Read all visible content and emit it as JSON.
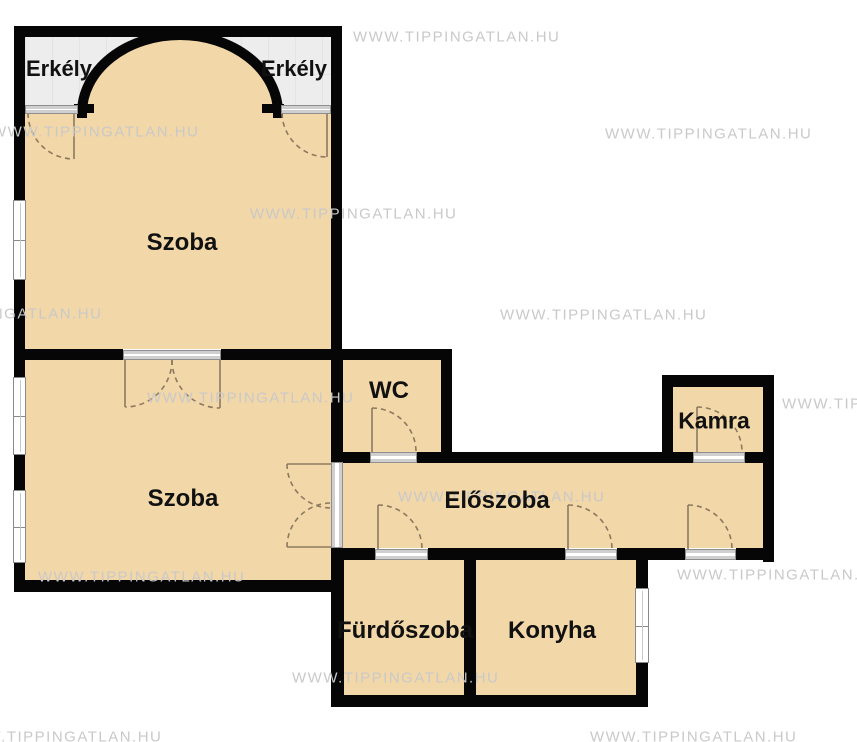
{
  "floor_plan": {
    "rooms": [
      {
        "id": "erkely-left",
        "label": "Erkély"
      },
      {
        "id": "erkely-right",
        "label": "Erkély"
      },
      {
        "id": "szoba-1",
        "label": "Szoba"
      },
      {
        "id": "szoba-2",
        "label": "Szoba"
      },
      {
        "id": "wc",
        "label": "WC"
      },
      {
        "id": "kamra",
        "label": "Kamra"
      },
      {
        "id": "eloszoba",
        "label": "Előszoba"
      },
      {
        "id": "furdoszoba",
        "label": "Fürdőszoba"
      },
      {
        "id": "konyha",
        "label": "Konyha"
      }
    ],
    "watermark": {
      "text": "WWW.TIPPINGATLAN.HU"
    },
    "colors": {
      "room": "#f2d7a8",
      "wall": "#060606",
      "balcony": "#ededed",
      "outside": "#ffffff",
      "watermark": "#c9c9c9",
      "door_arc": "#8c7a5f"
    }
  }
}
